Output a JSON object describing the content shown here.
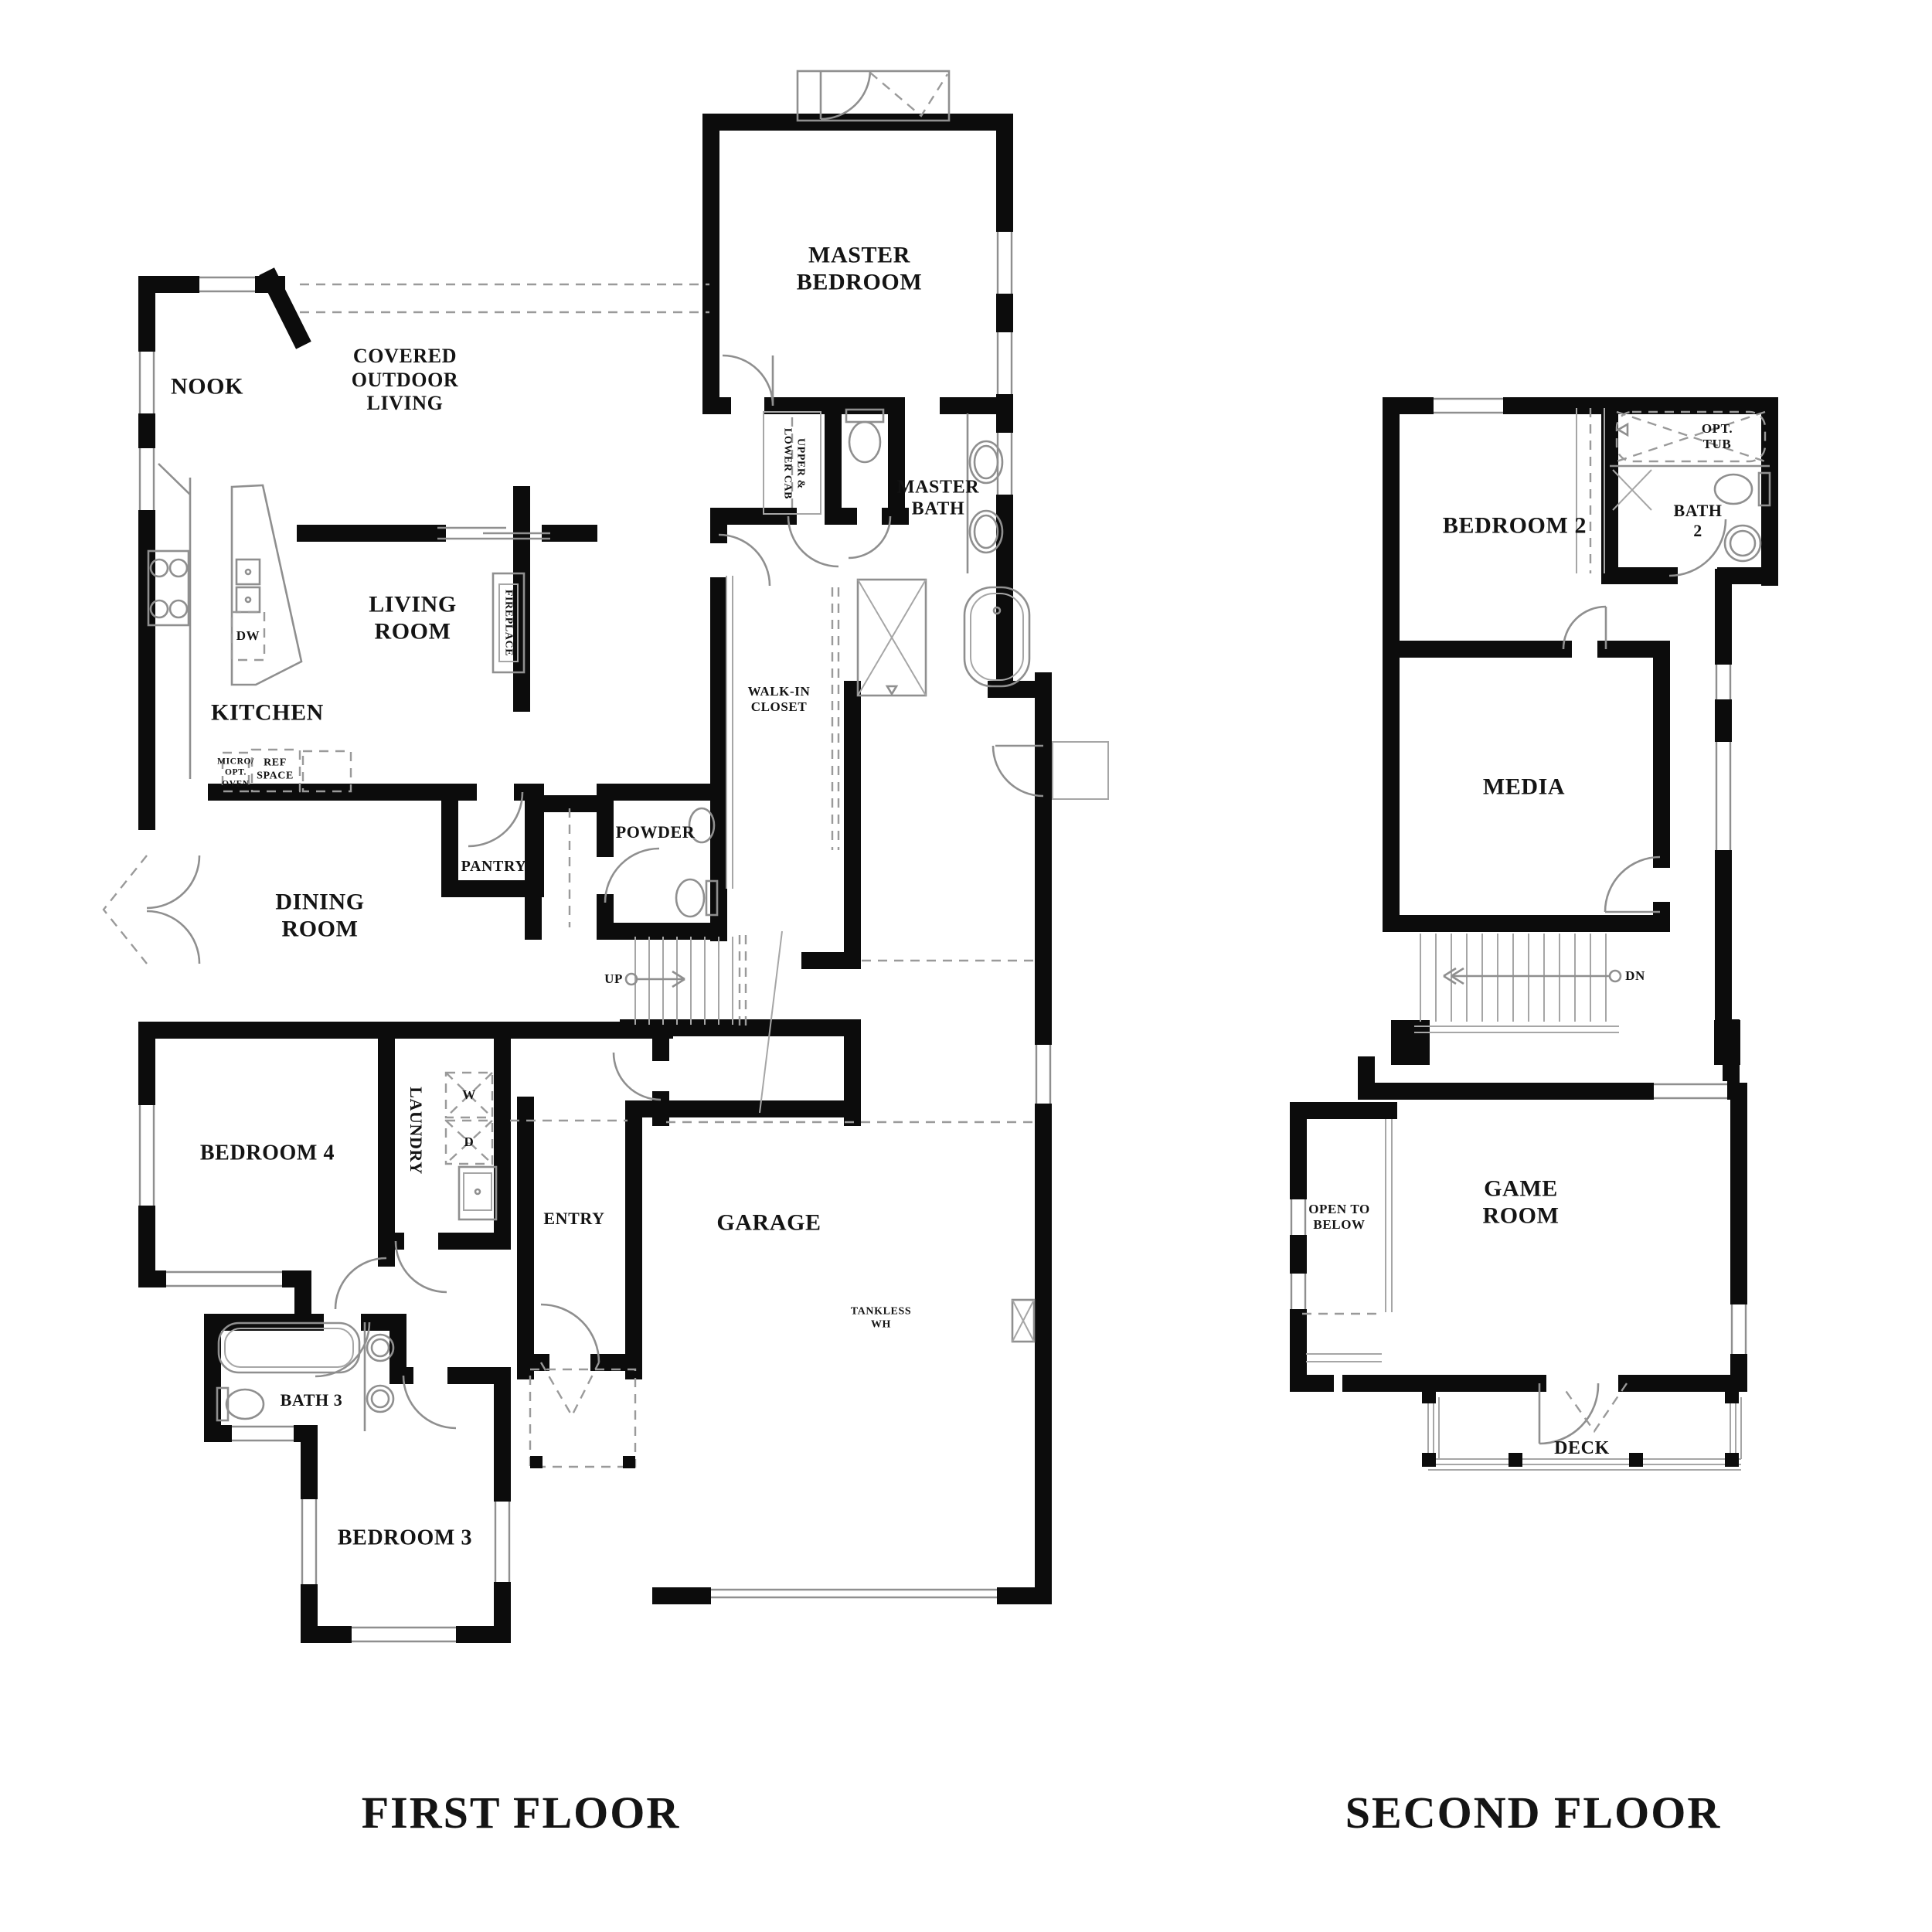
{
  "titles": {
    "first_floor": "FIRST FLOOR",
    "second_floor": "SECOND FLOOR"
  },
  "first_floor": {
    "rooms": {
      "master_bedroom": "MASTER\nBEDROOM",
      "nook": "NOOK",
      "covered_outdoor_living": "COVERED\nOUTDOOR\nLIVING",
      "master_bath": "MASTER\nBATH",
      "upper_lower_cab": "UPPER &\nLOWER CAB",
      "living_room": "LIVING\nROOM",
      "fireplace": "FIREPLACE",
      "kitchen": "KITCHEN",
      "dw": "DW",
      "walk_in_closet": "WALK-IN\nCLOSET",
      "micro_opt_oven": "MICRO/\nOPT.\nOVEN",
      "ref_space": "REF\nSPACE",
      "powder": "POWDER",
      "pantry": "PANTRY",
      "dining_room": "DINING\nROOM",
      "up": "UP",
      "bedroom_4": "BEDROOM 4",
      "laundry": "LAUNDRY",
      "washer": "W",
      "dryer": "D",
      "entry": "ENTRY",
      "garage": "GARAGE",
      "tankless_wh": "TANKLESS\nWH",
      "bath_3": "BATH 3",
      "bedroom_3": "BEDROOM 3"
    }
  },
  "second_floor": {
    "rooms": {
      "bedroom_2": "BEDROOM 2",
      "opt_tub": "OPT.\nTUB",
      "bath_2": "BATH\n2",
      "media": "MEDIA",
      "dn": "DN",
      "open_to_below": "OPEN TO\nBELOW",
      "game_room": "GAME\nROOM",
      "deck": "DECK"
    }
  },
  "colors": {
    "wall": "#0c0c0c",
    "fixture": "#8f8f8f",
    "background": "#ffffff",
    "text": "#141414"
  }
}
